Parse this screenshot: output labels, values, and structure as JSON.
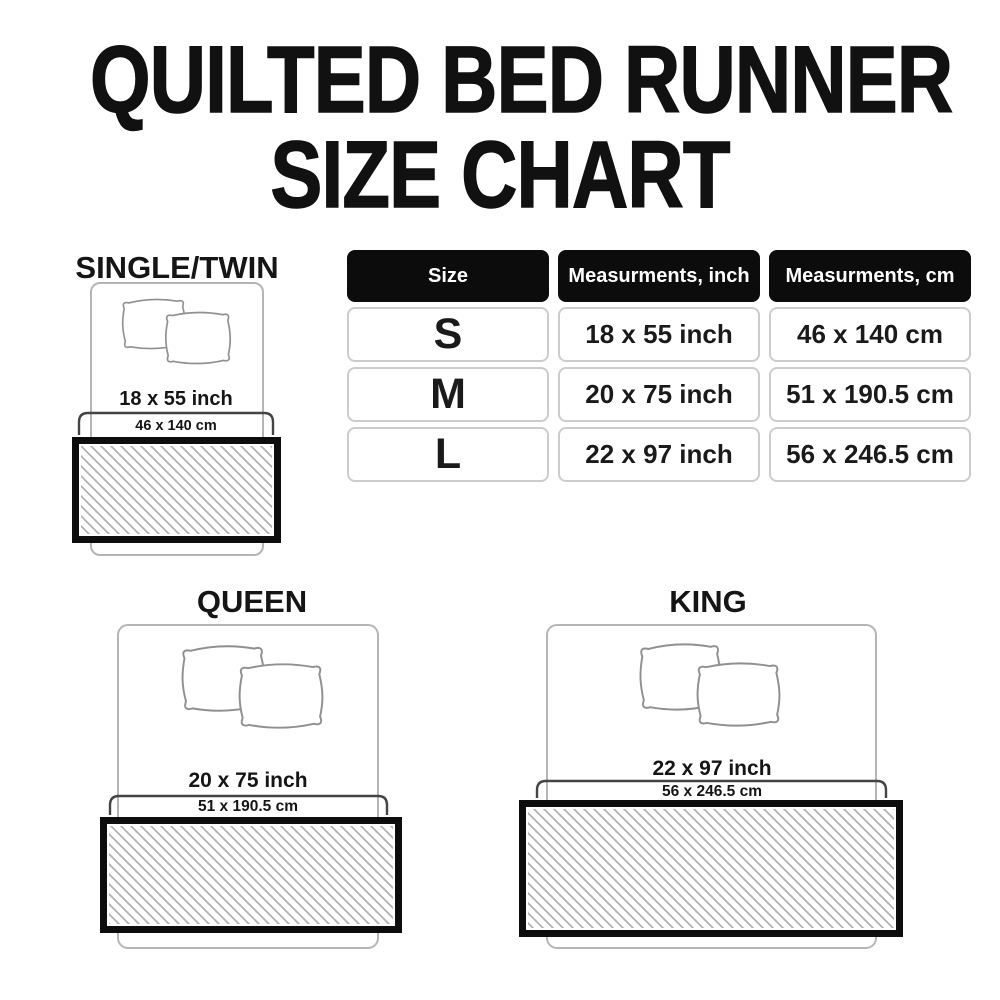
{
  "page": {
    "title_line1": "QUILTED BED RUNNER",
    "title_line2": "SIZE CHART"
  },
  "table": {
    "headers": [
      "Size",
      "Measurments, inch",
      "Measurments, cm"
    ],
    "rows": [
      {
        "size": "S",
        "inch": "18 x 55 inch",
        "cm": "46 x 140 cm"
      },
      {
        "size": "M",
        "inch": "20 x 75 inch",
        "cm": "51 x 190.5 cm"
      },
      {
        "size": "L",
        "inch": "22 x 97 inch",
        "cm": "56 x 246.5 cm"
      }
    ]
  },
  "diagrams": {
    "single": {
      "label": "SINGLE/TWIN",
      "inch": "18 x 55 inch",
      "cm": "46 x 140 cm"
    },
    "queen": {
      "label": "QUEEN",
      "inch": "20 x 75 inch",
      "cm": "51 x 190.5 cm"
    },
    "king": {
      "label": "KING",
      "inch": "22 x 97 inch",
      "cm": "56 x 246.5 cm"
    }
  },
  "colors": {
    "background": "#ffffff",
    "text": "#151515",
    "table_header_bg": "#0c0c0c",
    "table_header_text": "#ffffff",
    "table_cell_border": "#cccccc",
    "bed_outline": "#b5b5b5",
    "pillow_outline": "#909090",
    "bracket": "#444444",
    "runner_border": "#0d0d0d",
    "hatch_lines": "#b0b0b0"
  }
}
